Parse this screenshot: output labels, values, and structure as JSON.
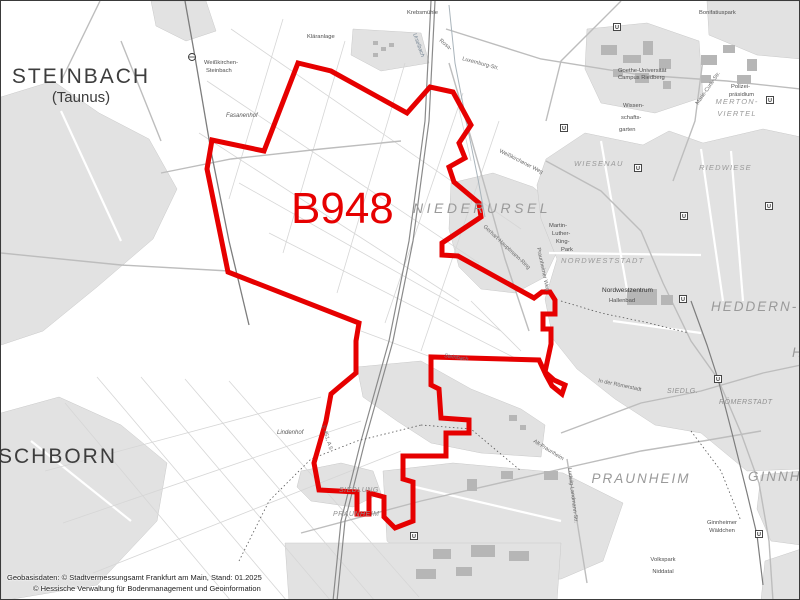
{
  "map": {
    "area_code": "B948",
    "colors": {
      "boundary": "#e60000",
      "area_label": "#e60000",
      "urban": "#e2e2e2",
      "urban_dark": "#d7d7d7",
      "building": "#b6b6b6",
      "road": "#bdbdbd",
      "field": "#d6d6d6",
      "rail": "#8a8a8a",
      "stream": "#a9b4bb",
      "label_dark": "#3d3d3d",
      "label_gray": "#9a9a9a",
      "label_small": "#4e4e4e"
    },
    "boundary_points": "297,62 330,70 406,112 429,86 452,91 470,124 458,142 464,157 448,166 453,181 478,202 480,216 441,242 441,254 457,255 533,297 541,291 549,291 554,299 554,313 542,313 542,328 550,328 550,343 544,371 553,379 564,384 561,393 551,385 545,374 538,359 430,356 430,384 438,388 440,417 468,419 468,432 445,432 445,455 402,455 402,478 412,481 412,520 394,527 383,516 383,496 368,492 368,513 356,513 356,491 318,489 313,462 325,420 330,393 337,387 355,372 355,340 358,322 227,271 206,168 211,139 263,150",
    "labels": [
      {
        "t": "B948",
        "x": 290,
        "y": 222,
        "c": "b948"
      },
      {
        "t": "STEINBACH",
        "x": 80,
        "y": 82,
        "c": "city",
        "a": "middle"
      },
      {
        "t": "(Taunus)",
        "x": 80,
        "y": 101,
        "c": "citysub",
        "a": "middle"
      },
      {
        "t": "SCHBORN",
        "x": -3,
        "y": 462,
        "c": "city"
      },
      {
        "t": "NIEDERURSEL",
        "x": 412,
        "y": 212,
        "c": "dxl"
      },
      {
        "t": "HEDDERN-",
        "x": 710,
        "y": 310,
        "c": "dlg"
      },
      {
        "t": "HE",
        "x": 791,
        "y": 356,
        "c": "dlg"
      },
      {
        "t": "PRAUNHEIM",
        "x": 640,
        "y": 482,
        "c": "dlg",
        "a": "middle"
      },
      {
        "t": "GINNH",
        "x": 747,
        "y": 480,
        "c": "dlg"
      },
      {
        "t": "RÖMERSTADT",
        "x": 718,
        "y": 403,
        "c": "dsm"
      },
      {
        "t": "SIEDLG.",
        "x": 666,
        "y": 392,
        "c": "dsm"
      },
      {
        "t": "NORDWESTSTADT",
        "x": 560,
        "y": 262,
        "c": "dm"
      },
      {
        "t": "WIESENAU",
        "x": 573,
        "y": 165,
        "c": "dm"
      },
      {
        "t": "RIEDWIESE",
        "x": 698,
        "y": 169,
        "c": "dm"
      },
      {
        "t": "MERTON-",
        "x": 736,
        "y": 103,
        "c": "dm",
        "a": "middle"
      },
      {
        "t": "VIERTEL",
        "x": 736,
        "y": 115,
        "c": "dm",
        "a": "middle"
      },
      {
        "t": "SIEDLUNG",
        "x": 338,
        "y": 491,
        "c": "dsm"
      },
      {
        "t": "PRAUNHEIM",
        "x": 332,
        "y": 515,
        "c": "dsm"
      },
      {
        "t": "Weißkirchen-",
        "x": 203,
        "y": 63,
        "c": "sm"
      },
      {
        "t": "Steinbach",
        "x": 205,
        "y": 71,
        "c": "sm"
      },
      {
        "t": "Fasanenhof",
        "x": 225,
        "y": 116,
        "c": "smi"
      },
      {
        "t": "Kläranlage",
        "x": 306,
        "y": 37,
        "c": "sm"
      },
      {
        "t": "Krebsmühle",
        "x": 406,
        "y": 13,
        "c": "sm"
      },
      {
        "t": "Bonifatiuspark",
        "x": 698,
        "y": 13,
        "c": "sm"
      },
      {
        "t": "Goethe-Universität",
        "x": 617,
        "y": 71,
        "c": "sm"
      },
      {
        "t": "Campus Riedberg",
        "x": 617,
        "y": 78,
        "c": "sm"
      },
      {
        "t": "Wissen-",
        "x": 622,
        "y": 106,
        "c": "sm"
      },
      {
        "t": "schafts-",
        "x": 620,
        "y": 118,
        "c": "sm"
      },
      {
        "t": "garten",
        "x": 618,
        "y": 130,
        "c": "sm"
      },
      {
        "t": "Polizei-",
        "x": 730,
        "y": 87,
        "c": "sm"
      },
      {
        "t": "präsidium",
        "x": 728,
        "y": 95,
        "c": "sm"
      },
      {
        "t": "Martin-",
        "x": 548,
        "y": 226,
        "c": "sm"
      },
      {
        "t": "Luther-",
        "x": 551,
        "y": 234,
        "c": "sm"
      },
      {
        "t": "King-",
        "x": 555,
        "y": 242,
        "c": "sm"
      },
      {
        "t": "Park",
        "x": 560,
        "y": 250,
        "c": "sm"
      },
      {
        "t": "Nordwestzentrum",
        "x": 601,
        "y": 291,
        "c": "smd"
      },
      {
        "t": "Hallenbad",
        "x": 608,
        "y": 301,
        "c": "sm"
      },
      {
        "t": "Lindenhof",
        "x": 276,
        "y": 433,
        "c": "smi"
      },
      {
        "t": "Ginnheimer",
        "x": 721,
        "y": 523,
        "c": "sm",
        "a": "middle"
      },
      {
        "t": "Wäldchen",
        "x": 721,
        "y": 531,
        "c": "sm",
        "a": "middle"
      },
      {
        "t": "Volkspark",
        "x": 662,
        "y": 560,
        "c": "sm",
        "a": "middle"
      },
      {
        "t": "Niddatal",
        "x": 662,
        "y": 572,
        "c": "sm",
        "a": "middle"
      },
      {
        "t": "Rosa-",
        "x": 438,
        "y": 40,
        "c": "road",
        "r": 40
      },
      {
        "t": "Luxemburg-Str.",
        "x": 461,
        "y": 59,
        "c": "road",
        "r": 15
      },
      {
        "t": "Urselbach",
        "x": 412,
        "y": 33,
        "c": "stream",
        "r": 70
      },
      {
        "t": "Marie-Curie-Str.",
        "x": 697,
        "y": 104,
        "c": "road",
        "r": -55
      },
      {
        "t": "Weißkirchener Weg",
        "x": 498,
        "y": 151,
        "c": "road",
        "r": 27
      },
      {
        "t": "Gerhart-Hauptmann-Ring",
        "x": 482,
        "y": 226,
        "c": "road",
        "r": 43
      },
      {
        "t": "Praunheimer Weg",
        "x": 536,
        "y": 247,
        "c": "road",
        "r": 78
      },
      {
        "t": "In der Römerstadt",
        "x": 597,
        "y": 381,
        "c": "road",
        "r": 12
      },
      {
        "t": "E 451, A 5",
        "x": 321,
        "y": 425,
        "c": "road",
        "r": 73
      },
      {
        "t": "Alt-Praunheim",
        "x": 532,
        "y": 441,
        "c": "road",
        "r": 32
      },
      {
        "t": "Ludwig-Landmann-Str.",
        "x": 567,
        "y": 467,
        "c": "road",
        "r": 83
      },
      {
        "t": "Steinbach",
        "x": 443,
        "y": 356,
        "c": "stream",
        "r": 9
      }
    ],
    "u_stations": [
      {
        "x": 616,
        "y": 26
      },
      {
        "x": 563,
        "y": 127
      },
      {
        "x": 637,
        "y": 167
      },
      {
        "x": 769,
        "y": 99
      },
      {
        "x": 683,
        "y": 215
      },
      {
        "x": 768,
        "y": 205
      },
      {
        "x": 682,
        "y": 298
      },
      {
        "x": 717,
        "y": 378
      },
      {
        "x": 413,
        "y": 535
      },
      {
        "x": 758,
        "y": 533
      }
    ],
    "s_stations": [
      {
        "x": 191,
        "y": 56
      }
    ],
    "attribution": {
      "line1": "Geobasisdaten: © Stadtvermessungsamt Frankfurt am Main, Stand: 01.2025",
      "line2": "© Hessische Verwaltung für Bodenmanagement und Geoinformation"
    }
  }
}
